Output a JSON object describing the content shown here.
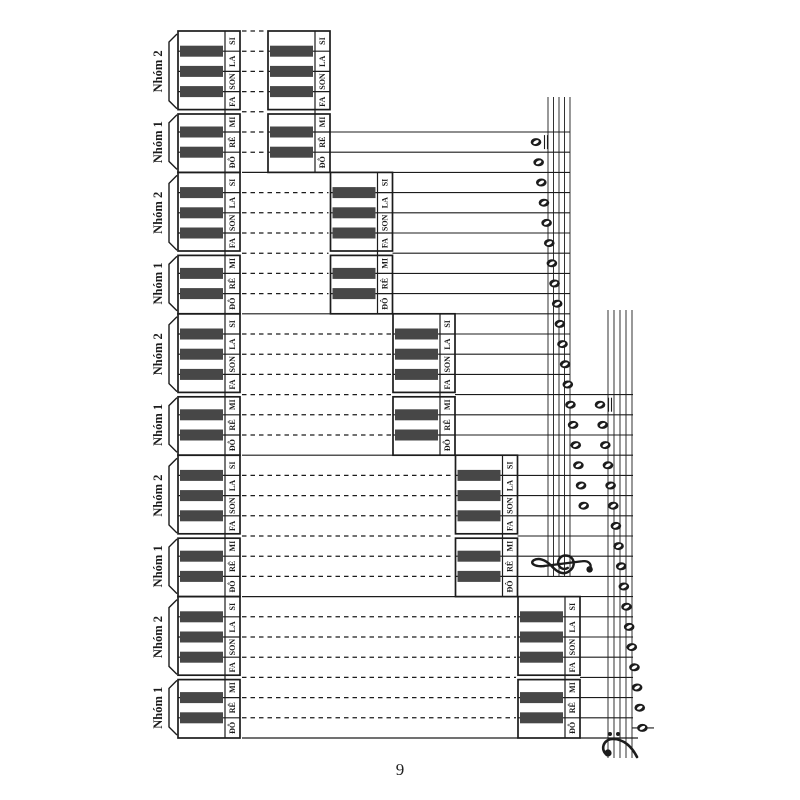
{
  "page_number": "9",
  "groups": [
    {
      "id": "nhom2",
      "label": "Nhóm 2",
      "keys": [
        "SI",
        "LA",
        "SON",
        "FA"
      ],
      "black_keys": 3
    },
    {
      "id": "nhom1",
      "label": "Nhóm 1",
      "keys": [
        "MI",
        "RÊ",
        "ĐÔ"
      ],
      "black_keys": 2
    }
  ],
  "note_names_top_to_bottom": [
    "SI",
    "LA",
    "SON",
    "FA",
    "MI",
    "RÊ",
    "ĐÔ"
  ],
  "octave_row_count": 5,
  "keyboards_per_row": 2,
  "treble_staff_notes": [
    {
      "octave_row": 1,
      "notes": [
        "RÊ",
        "ĐÔ"
      ]
    },
    {
      "octave_row": 2,
      "notes": [
        "SI",
        "LA",
        "SON",
        "FA",
        "MI",
        "RÊ",
        "ĐÔ"
      ]
    },
    {
      "octave_row": 3,
      "notes": [
        "SI",
        "LA",
        "SON",
        "FA",
        "MI",
        "RÊ",
        "ĐÔ"
      ]
    },
    {
      "octave_row": 4,
      "notes": [
        "SI",
        "LA",
        "SON"
      ]
    }
  ],
  "bass_staff_notes": [
    {
      "octave_row": 3,
      "notes": [
        "MI",
        "RÊ",
        "ĐÔ"
      ]
    },
    {
      "octave_row": 4,
      "notes": [
        "SI",
        "LA",
        "SON",
        "FA",
        "MI",
        "RÊ",
        "ĐÔ"
      ]
    },
    {
      "octave_row": 5,
      "notes": [
        "SI",
        "LA",
        "SON",
        "FA",
        "MI",
        "RÊ",
        "ĐÔ"
      ]
    }
  ],
  "staves": [
    {
      "id": "treble",
      "clef_icon": "treble-clef-icon",
      "line_count": 5
    },
    {
      "id": "bass",
      "clef_icon": "bass-clef-icon",
      "line_count": 5
    }
  ],
  "colors": {
    "ink": "#1c1c1c",
    "black_key": "#474747",
    "paper": "#ffffff"
  }
}
